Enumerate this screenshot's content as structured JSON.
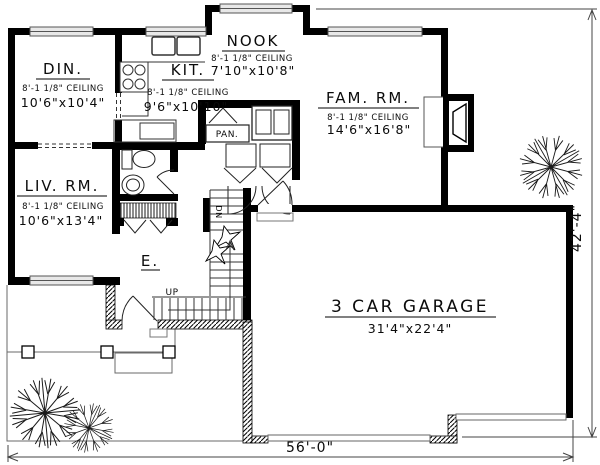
{
  "rooms": {
    "dining": {
      "name": "DIN.",
      "ceiling": "8'-1 1/8\" CEILING",
      "size": "10'6\"x10'4\""
    },
    "kitchen": {
      "name": "KIT.",
      "ceiling": "8'-1 1/8\" CEILING",
      "size": "9'6\"x10'10\""
    },
    "nook": {
      "name": "NOOK",
      "ceiling": "8'-1 1/8\" CEILING",
      "size": "7'10\"x10'8\""
    },
    "family_room": {
      "name": "FAM. RM.",
      "ceiling": "8'-1 1/8\" CEILING",
      "size": "14'6\"x16'8\""
    },
    "living_room": {
      "name": "LIV. RM.",
      "ceiling": "8'-1 1/8\" CEILING",
      "size": "10'6\"x13'4\""
    },
    "garage": {
      "name": "3 CAR GARAGE",
      "size": "31'4\"x22'4\""
    },
    "pantry": {
      "name": "PAN."
    },
    "entry": {
      "name": "E."
    }
  },
  "stairs": {
    "up": "UP",
    "down": "DN"
  },
  "dimensions": {
    "width": "56'-0\"",
    "depth": "42'-4\""
  },
  "colors": {
    "wall": "#000000",
    "thin_line": "#3a3a3a",
    "window_fill": "#e8e8e8",
    "paper": "#ffffff"
  }
}
